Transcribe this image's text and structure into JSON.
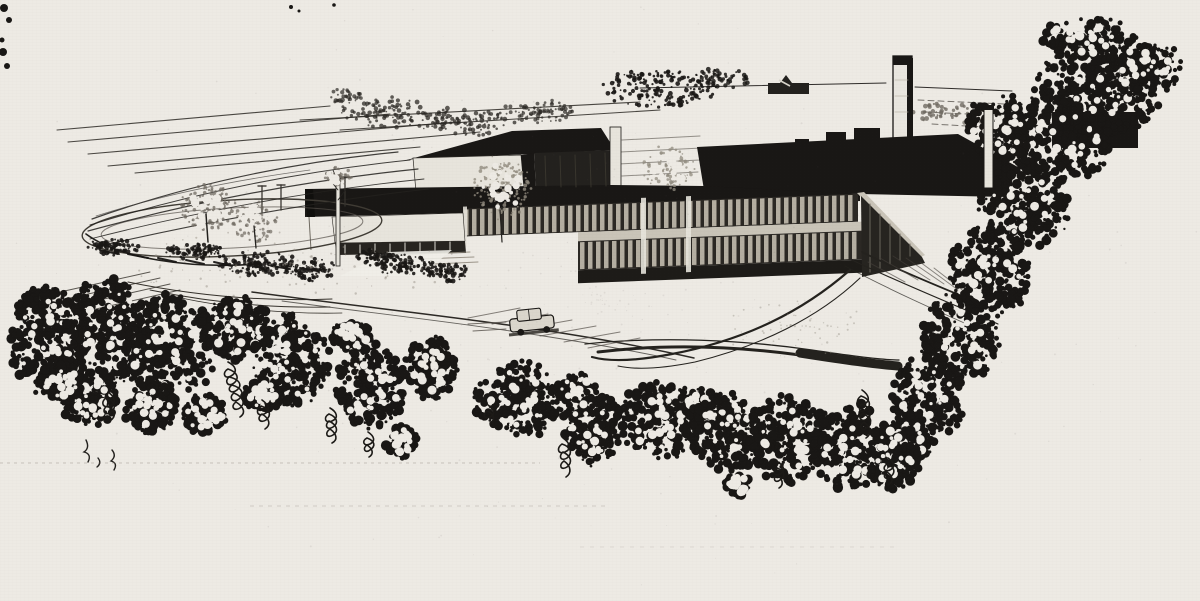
{
  "artwork": {
    "title": "Aerial perspective ink rendering of a modern flat-roofed industrial plant",
    "medium": "black-and-white ink / halftone book illustration",
    "alt": "Bird's-eye ink drawing: a long low factory with a dark flat roof, tall rectangular smokestack, two bands of ribbon windows, a white clerestory block and one-story office wing, an oval entrance drive with small trees and shrubs, a sedan on the approach road, hatched distant fields with a small farmhouse on the horizon, and dense dark tree canopy framing the bottom and right edges of the scene."
  },
  "palette": {
    "paper": "#edeae4",
    "ink": "#191715",
    "ink2": "#2c2925",
    "face": "#262420",
    "gray": "#6f6a61",
    "gray2": "#928c80",
    "wall": "#e7e4dc",
    "bar": "#b4aea1",
    "spandrel": "#c9c4b8"
  },
  "scene": {
    "elements": [
      "sky of blank paper",
      "hatched distant fields",
      "horizon treeline and hedgerows",
      "small farmhouse silhouette",
      "tall smokestack",
      "flat dark factory roof",
      "white clerestory block",
      "two-story ribbon-window facade",
      "one-story office wing",
      "oval entrance driveway with lawn trees and shrubs",
      "sedan on approach road",
      "curving service road",
      "foreground tree canopy with hanging vines",
      "large tree mass along right edge"
    ]
  }
}
